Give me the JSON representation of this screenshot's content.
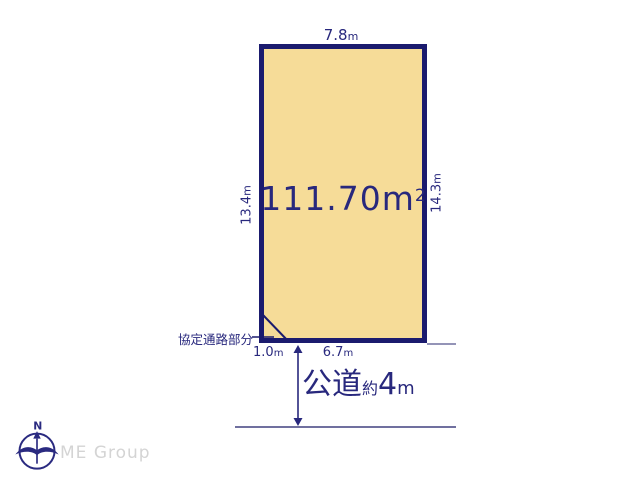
{
  "diagram": {
    "plot": {
      "area": {
        "value": "111.70",
        "unit": "m",
        "sup": "2"
      },
      "dims": {
        "top": {
          "value": "7.8",
          "unit": "m"
        },
        "left": {
          "value": "13.4",
          "unit": "m"
        },
        "right": {
          "value": "14.3",
          "unit": "m"
        },
        "bottom": {
          "value": "6.7",
          "unit": "m"
        },
        "corner": {
          "value": "1.0",
          "unit": "m"
        }
      },
      "corner_note": "協定通路部分"
    },
    "road": {
      "label": "公道",
      "approx": "約",
      "value": "4",
      "unit": "m"
    },
    "colors": {
      "plot_fill": "#f6dc98",
      "boundary_navy": "#1b1b6e",
      "text_navy": "#28287d",
      "road_line": "#70709f",
      "logo_gray": "#d4d4d4"
    }
  },
  "footer": {
    "logo_text": "ME Group",
    "compass_n": "N"
  }
}
